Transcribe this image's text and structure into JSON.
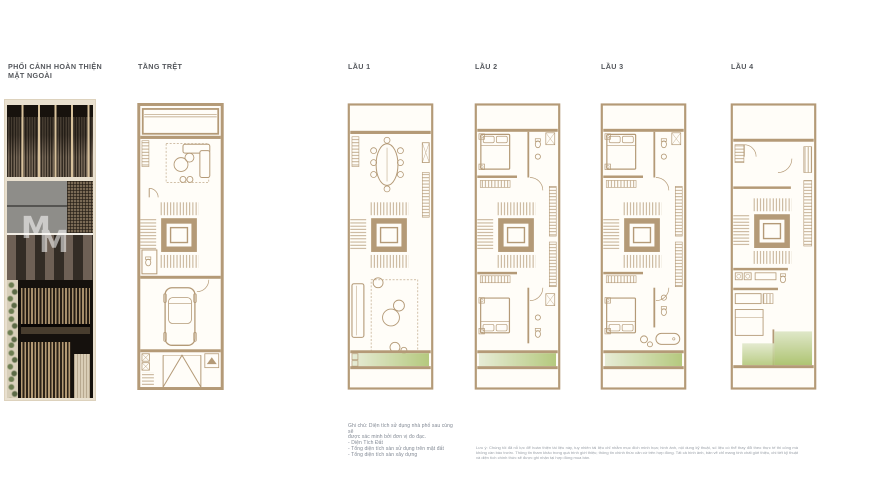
{
  "colors": {
    "plan_line": "#b49a77",
    "plan_background": "#fffdf8",
    "balcony_green": "#b5c97e",
    "balcony_green_light": "#e7ecd6",
    "heading_text": "#54575c",
    "note_text": "#818893"
  },
  "panels": [
    {
      "id": "perspective",
      "title_line1": "PHỐI CẢNH HOÀN THIỆN",
      "title_line2": "MẶT NGOÀI"
    },
    {
      "id": "tang-tret",
      "title": "TẦNG TRỆT"
    },
    {
      "id": "lau-1",
      "title": "LẦU 1"
    },
    {
      "id": "lau-2",
      "title": "LẦU 2"
    },
    {
      "id": "lau-3",
      "title": "LẦU 3"
    },
    {
      "id": "lau-4",
      "title": "LẦU 4"
    }
  ],
  "watermark": {
    "monogram": "M"
  },
  "notes": {
    "lines": [
      "Ghi chú: Diện tích sử dụng nhà phố sau cùng sẽ",
      "được xác minh bởi đơn vị đo đạc.",
      "- Diện Tích Đất",
      "- Tổng diện tích sàn sử dụng trên mặt đất",
      "- Tổng diện tích sàn xây dựng"
    ]
  },
  "disclaimer": {
    "text": "Lưu ý: Chúng tôi đã nỗ lực để hoàn thiện tài liệu này, tuy nhiên tài liệu chỉ nhằm mục đích minh họa; hình ảnh, nội dung kỹ thuật, số liệu có thể thay đổi theo thực tế thi công mà không cần báo trước. Thông tin tham khảo trong quá trình giới thiệu; thông tin chính thức căn cứ trên hợp đồng. Tất cả hình ảnh, bản vẽ chỉ mang tính chất giới thiệu, chi tiết kỹ thuật và diện tích chính thức sẽ được ghi nhận tại hợp đồng mua bán."
  }
}
